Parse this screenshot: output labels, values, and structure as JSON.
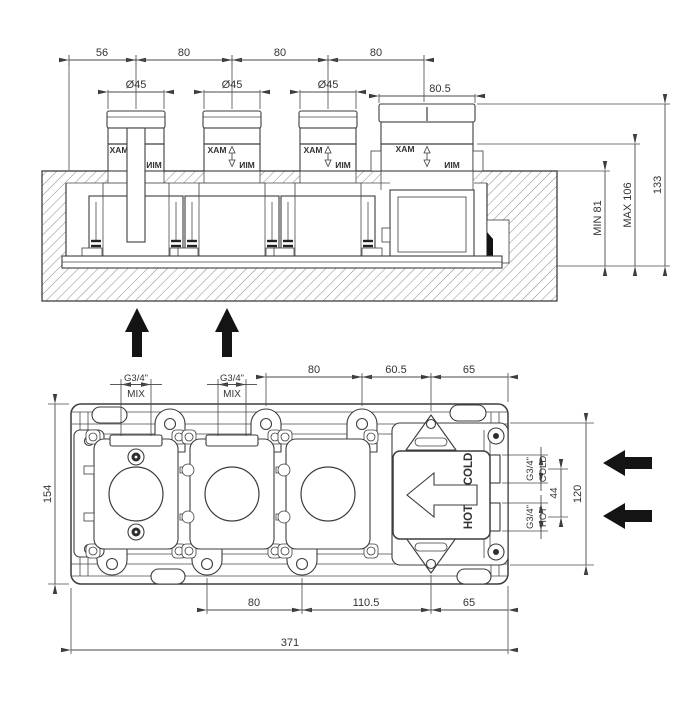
{
  "top": {
    "chain": [
      "56",
      "80",
      "80",
      "80"
    ],
    "dia": "Ø45",
    "thermo_width": "80.5",
    "min_depth": "MIN 81",
    "max_depth": "MAX 106",
    "total_height": "133",
    "max_label": "MAX",
    "min_label": "MIN"
  },
  "plan": {
    "top_chain": [
      "80",
      "60.5",
      "65"
    ],
    "bottom_chain": [
      "80",
      "110.5",
      "65"
    ],
    "overall_width": "371",
    "body_height": "154",
    "frame_height": "120",
    "port_gap": "44",
    "thread": "G3/4\"",
    "mix": "MIX",
    "hot": "HOT",
    "cold": "COLD"
  },
  "colors": {
    "line": "#3d3d3d",
    "arrow": "#141414",
    "background": "#ffffff"
  }
}
